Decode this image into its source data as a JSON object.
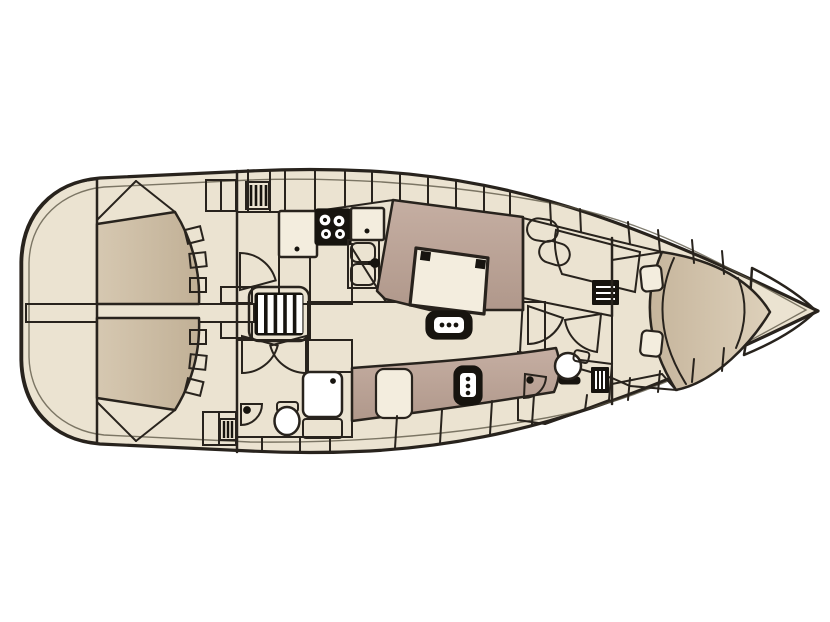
{
  "diagram": {
    "type": "yacht-interior-floor-plan",
    "view": "top-down",
    "orientation": "bow-right-stern-left",
    "areas": [
      {
        "name": "swim-platform",
        "position": "stern-far-left"
      },
      {
        "name": "cockpit",
        "position": "aft",
        "features": [
          "port-bench",
          "starboard-bench",
          "center-walkway",
          "bench-steps",
          "stern-lockers",
          "deck-grate"
        ]
      },
      {
        "name": "companionway",
        "features": [
          "steps-ladder",
          "port-aft-cabin-door",
          "aft-head-bifold-door"
        ]
      },
      {
        "name": "galley",
        "position": "port-amidships",
        "features": [
          "overhead-lockers",
          "vent-grate",
          "counter-left",
          "stove-4-burner",
          "counter-right",
          "double-sink-with-faucet"
        ]
      },
      {
        "name": "salon",
        "features": [
          "u-settee-port",
          "dinette-table",
          "folding-stool",
          "settee-starboard",
          "nav-seat",
          "mast-post",
          "hull-lockers"
        ]
      },
      {
        "name": "aft-head",
        "position": "starboard-aft-of-salon",
        "features": [
          "shower-with-drain",
          "toilet",
          "corner-washbasin",
          "vanity-cabinet"
        ]
      },
      {
        "name": "wardrobe",
        "position": "port-forward-of-salon",
        "features": [
          "locker-doors",
          "seat",
          "shelf-unit"
        ]
      },
      {
        "name": "forward-head",
        "features": [
          "toilet",
          "corner-washbasin",
          "vent-grate",
          "bifold-door"
        ]
      },
      {
        "name": "forward-cabin",
        "features": [
          "v-berth",
          "berth-steps",
          "side-shelves",
          "headboard-shelf"
        ]
      },
      {
        "name": "anchor-locker",
        "position": "bow-far-right"
      }
    ],
    "fixture_count": {
      "berths": 1,
      "heads": 2,
      "showers": 1,
      "stoves": 1,
      "sinks": 4,
      "tables": 1
    }
  },
  "colors": {
    "outline": "#28231d",
    "deck": "#ebe3d1",
    "deckLight": "#f3edde",
    "tan": "#d6c8b1",
    "tanDeep": "#c1b096",
    "tanDark": "#a5917e",
    "upholstery": "#c5aea2",
    "upholsteryDeep": "#b0988b",
    "bed": "#ddd0ba",
    "bedDeep": "#c6b59c",
    "floor": "#6e6459",
    "floorLight": "#867a6b",
    "walkway": "#d7d6d4",
    "platform": "#bdbec2",
    "platformLight": "#f1f1f1",
    "steps": "#ddd6c4",
    "white": "#ffffff",
    "black": "#17140f"
  }
}
